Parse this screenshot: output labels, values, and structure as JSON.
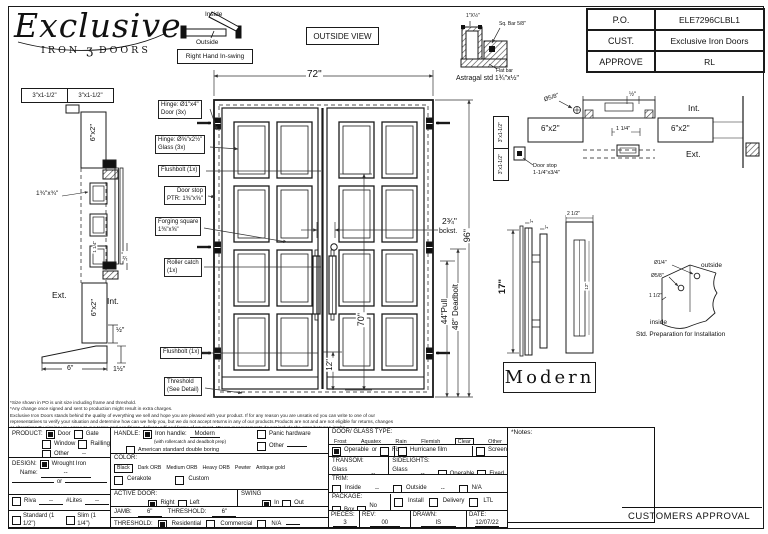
{
  "logo": {
    "script": "Exclusive",
    "iron": "IRON",
    "ornament": "ʒ",
    "doors": "DOORS"
  },
  "swing_legend": {
    "inside": "Inside",
    "outside": "Outside",
    "caption": "Right Hand In-swing"
  },
  "view_label": "OUTSIDE VIEW",
  "astragal": {
    "dim": "1\"X½\"",
    "sq_bar": "Sq. Bar 5/8\"",
    "flat_bar": "Flat bar",
    "caption": "Astragal std 1¾\"x½\""
  },
  "po_table": {
    "po_label": "P.O.",
    "po_value": "ELE7296CLBL1",
    "cust_label": "CUST.",
    "cust_value": "Exclusive Iron Doors",
    "approve_label": "APPROVE",
    "approve_value": "RL"
  },
  "door_view": {
    "width_dim": "72\"",
    "height_dim": "96\"",
    "glass_height_dim": "70\"",
    "bottom_dim": "12\"",
    "backset_dim": "2¾\"",
    "backset_sub": "bckst.",
    "pull_dim": "44\"Pull",
    "deadbolt_dim": "48\" Deadbolt",
    "callouts": {
      "hinge_door": "Hinge: Ø1\"x4\"\nDoor (3x)",
      "hinge_glass": "Hinge: Ø⅝\"x2½\"\nGlass (3x)",
      "flushbolt_top": "Flushbolt (1x)",
      "door_stop": "Door stop\nPTR: 1⅜\"x⅝\"",
      "forging": "Forging square\n1⅜\"x⅝\"",
      "roller": "Roller catch\n(1x)",
      "flushbolt_bottom": "Flushbolt (1x)",
      "threshold": "Threshold\n(See Detail)"
    }
  },
  "left_section": {
    "jamb1": "3\"x1-1/2\"",
    "jamb2": "3\"x1-1/2\"",
    "frame_top": "6\"x2\"",
    "frame_bottom": "6\"x2\"",
    "stop_dim": "1¾\"x¾\"",
    "one_quarter": "1 1/4\"",
    "half_top": "½\"",
    "half_bottom": "½\"",
    "ext": "Ext.",
    "int": "Int.",
    "threshold_width": "6\"",
    "threshold_height": "1½\""
  },
  "head_section": {
    "diameter": "Ø5/8\"",
    "half": "½\"",
    "int": "Int.",
    "ext": "Ext.",
    "left_frame": "6\"x2\"",
    "right_frame": "6\"x2\"",
    "gap": "1 1/4\"",
    "jamb1": "3\"x1-1/2\"",
    "jamb2": "3\"x1-1/2\"",
    "door_stop": "Door stop\n1-1/4\"x3/4\""
  },
  "handle_detail": {
    "height": "17\"",
    "one": "1\"",
    "width": "2 1/2\"",
    "inner": "12\"",
    "style": "Modern"
  },
  "prep_detail": {
    "d1": "Ø1/4\"",
    "d2": "Ø5/8\"",
    "d3": "1 1/2\"",
    "outside": "outside",
    "inside": "inside",
    "caption": "Std. Preparation for Installation"
  },
  "disclaimer": [
    "*Size shown in PO is unit size including frame and threshold.",
    "*Any change once signed and sent to production might result in extra charges.",
    "Exclusive Iron Doors stands behind the quality of everything we sell and hope you are pleased with your product. If for any reason you are unsatis ed you can write to one of our representatives to verify your situation and determine how can we help you, but we do not accept returns in any of our products.Products are not and are not eligible for returns, changes",
    "or alterations.By signing you agree to our terms and conditions, delivery pdf and forms of payment. *Doors measurements do not include the gaps between jambs"
  ],
  "notes_label": "*Notes:",
  "approval_label": "CUSTOMERS APPROVAL",
  "form": {
    "product": {
      "label": "PRODUCT:",
      "door": {
        "label": "Door",
        "checked": true
      },
      "gate": {
        "label": "Gate",
        "checked": false
      },
      "window": {
        "label": "Window",
        "checked": false
      },
      "railing": {
        "label": "Railling",
        "checked": false
      },
      "other": {
        "label": "Other",
        "value": "--",
        "checked": false
      }
    },
    "design": {
      "label": "DESIGN:",
      "wrought": {
        "label": "Wrought Iron",
        "checked": true
      },
      "name_label": "Name:",
      "name_value": "--",
      "or_label": "or"
    },
    "riva": {
      "label": "Riva",
      "value": "--",
      "checked": false,
      "lites_label": "#Lites",
      "lites_value": "--"
    },
    "thickness": {
      "standard": {
        "label": "Standard (1 1/2\")",
        "checked": false
      },
      "slim": {
        "label": "Slim (1 1/4\")",
        "checked": false
      }
    },
    "handle": {
      "label": "HANDLE:",
      "iron": {
        "label": "Iron handle:",
        "value": "Modern",
        "checked": true,
        "note": "(with rollercatch and deadbolt prep)"
      },
      "american": {
        "label": "American standard double boring",
        "checked": false
      },
      "panic": {
        "label": "Panic hardware",
        "checked": false
      },
      "other": {
        "label": "Other",
        "checked": false
      }
    },
    "color": {
      "label": "COLOR:",
      "opt1": "Black",
      "opt2": "Dark ORB",
      "opt3": "Medium ORB",
      "opt4": "Heavy ORB",
      "opt5": "Pewter",
      "opt6": "Antique gold",
      "selected": "Black",
      "cerakote": {
        "label": "Cerakote",
        "checked": false
      },
      "custom": {
        "label": "Custom",
        "checked": false
      }
    },
    "active_door": {
      "label": "ACTIVE DOOR:",
      "right": {
        "label": "Right",
        "checked": true
      },
      "left": {
        "label": "Left",
        "checked": false
      }
    },
    "swing": {
      "label": "SWING",
      "in": {
        "label": "In",
        "checked": true
      },
      "out": {
        "label": "Out",
        "checked": false
      }
    },
    "jamb": {
      "label": "JAMB:",
      "value": "6\"",
      "threshold_label": "THRESHOLD:",
      "threshold_value": "6\""
    },
    "threshold": {
      "label": "THRESHOLD:",
      "residential": {
        "label": "Residential",
        "checked": true
      },
      "commercial": {
        "label": "Commercial",
        "checked": false
      },
      "na": {
        "label": "N/A",
        "checked": false
      }
    },
    "glass": {
      "label": "DOOR/ GLASS TYPE:",
      "opt1": "Frost",
      "opt2": "Aquatex",
      "opt3": "Rain",
      "opt4": "Flemish",
      "opt5": "Clear",
      "opt6": "Other",
      "selected": "Clear",
      "operable": {
        "label": "Operable",
        "checked": true
      },
      "or_label": "or",
      "fixed": {
        "label": "Fixed",
        "checked": false
      },
      "hurricane": {
        "label": "Hurricane film",
        "checked": false
      },
      "screen": {
        "label": "Screen",
        "checked": false
      }
    },
    "transom": {
      "label": "TRANSOM:",
      "glass_label": "Glass type:",
      "value": "--"
    },
    "sidelights": {
      "label": "SIDELIGHTS:",
      "glass_label": "Glass type:",
      "value": "--",
      "operable": {
        "label": "Operable",
        "checked": false
      },
      "fixed": {
        "label": "Fixed",
        "checked": false
      }
    },
    "trim": {
      "label": "TRIM:",
      "inside": {
        "label": "Inside",
        "value": "--",
        "checked": false
      },
      "outside": {
        "label": "Outside",
        "value": "--",
        "checked": false
      },
      "na": {
        "label": "N/A",
        "checked": false
      }
    },
    "package": {
      "label": "PACKAGE:",
      "box": {
        "label": "Box",
        "checked": false
      },
      "nobox": {
        "label": "No box",
        "checked": false
      },
      "install": {
        "label": "Install",
        "checked": false
      },
      "delivery": {
        "label": "Delivery",
        "checked": false
      },
      "ltl": {
        "label": "LTL",
        "checked": false
      }
    },
    "meta": {
      "pieces_label": "PIECES:",
      "pieces": "3",
      "rev_label": "REV:",
      "rev": "00",
      "drawn_label": "DRAWN:",
      "drawn": "IS",
      "date_label": "DATE:",
      "date": "12/07/22"
    }
  }
}
